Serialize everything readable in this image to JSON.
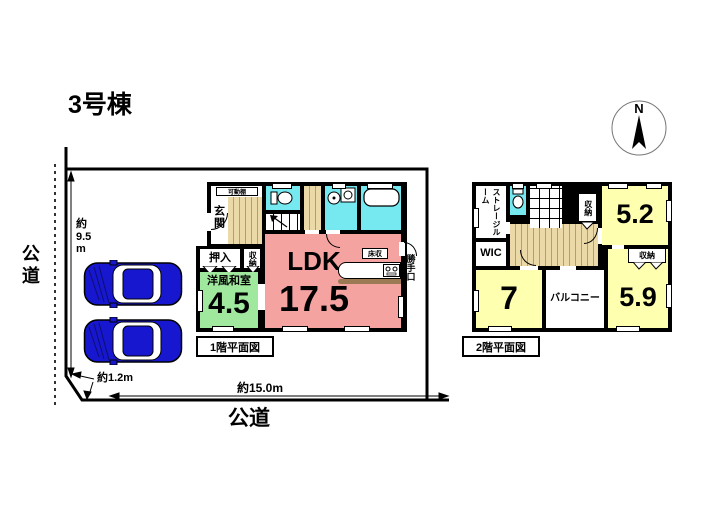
{
  "title": "3号棟",
  "compass": {
    "label": "N"
  },
  "site": {
    "road_left": "公道",
    "road_bottom": "公道",
    "dim_left": "約\n9.5\nm",
    "dim_corner": "約1.2m",
    "dim_bottom": "約15.0m"
  },
  "floor1": {
    "caption": "1階平面図",
    "genkan": "玄関",
    "kadodana": "可動棚",
    "oshiire": "押入",
    "shuno": "収納",
    "washitsu_name": "洋風和室",
    "washitsu_size": "4.5",
    "ldk_name": "LDK",
    "ldk_size": "17.5",
    "yukashu": "床収",
    "katteguchi": "勝手口"
  },
  "floor2": {
    "caption": "2階平面図",
    "storage": "ストレージルーム",
    "shuno_top": "収納",
    "room52": "5.2",
    "wic": "WIC",
    "room7": "7",
    "balcony": "バルコニー",
    "shuno_right": "収納",
    "room59": "5.9"
  },
  "colors": {
    "ldk_pink": "#f4a3a0",
    "tatami_green": "#a0e89d",
    "room_yellow": "#ffffb0",
    "water_cyan": "#76e8f0",
    "wood_tan": "#ecd9a8",
    "car_blue": "#1717d0",
    "wall_black": "#000000"
  }
}
